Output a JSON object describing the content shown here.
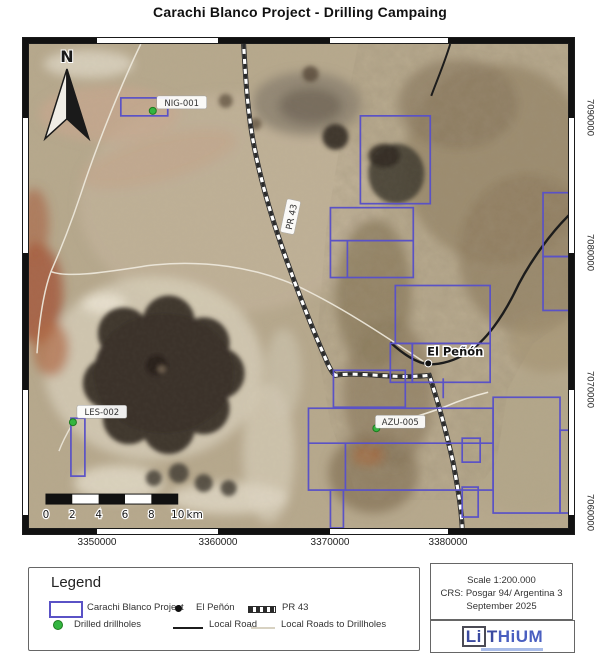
{
  "title": "Carachi Blanco Project - Drilling Campaing",
  "map": {
    "north_label": "N",
    "axis": {
      "x_ticks": [
        "3350000",
        "3360000",
        "3370000",
        "3380000"
      ],
      "y_ticks": [
        "7090000",
        "7080000",
        "7070000",
        "7060000"
      ]
    },
    "markers": {
      "nig": "NIG-001",
      "les": "LES-002",
      "azu": "AZU-005",
      "town": "El Peñón",
      "route": "PR 43"
    },
    "scalebar": {
      "labels": [
        "0",
        "2",
        "4",
        "6",
        "8",
        "10"
      ],
      "unit": "km"
    }
  },
  "legend": {
    "title": "Legend",
    "items": [
      {
        "swatch": "project-boundary",
        "label": "Carachi Blanco Project"
      },
      {
        "swatch": "town-dot",
        "label": "El Peñón"
      },
      {
        "swatch": "chain-road",
        "label": "PR 43"
      },
      {
        "swatch": "drillhole-dot",
        "label": "Drilled drillholes"
      },
      {
        "swatch": "black-line",
        "label": "Local Road"
      },
      {
        "swatch": "gray-line",
        "label": "Local Roads to Drillholes"
      }
    ]
  },
  "info": {
    "scale": "Scale 1:200.000",
    "crs": "CRS: Posgar 94/ Argentina 3",
    "date": "September 2025"
  },
  "logo": {
    "part1": "Li",
    "part2": "T",
    "part3": "HiUM"
  },
  "colors": {
    "project_boundary": "#5a52c6",
    "drillhole": "#33b540",
    "local_road": "#1c1c1c",
    "pr43_road": "#2b2b2b"
  }
}
